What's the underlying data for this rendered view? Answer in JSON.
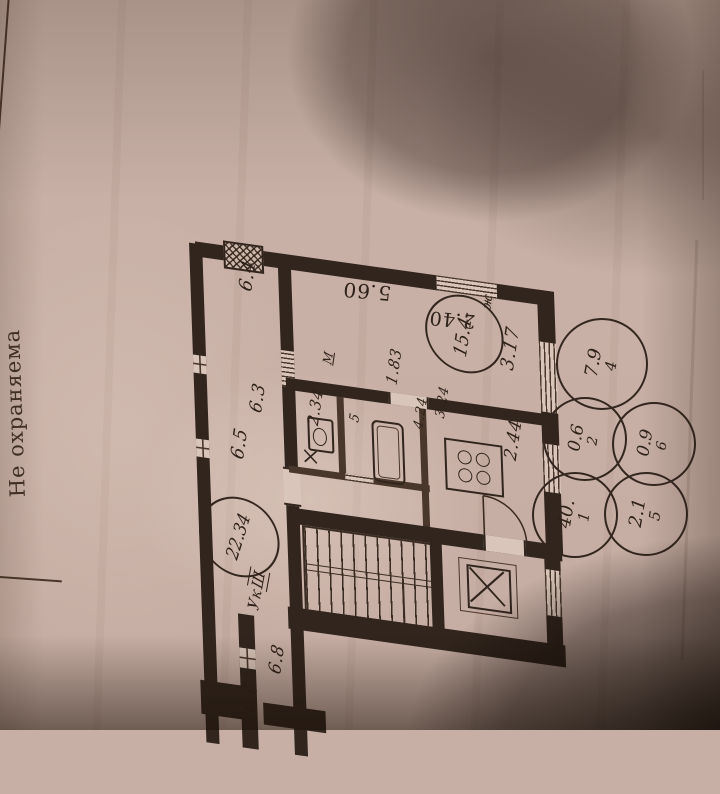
{
  "colors": {
    "paper": "#cab2a8",
    "ink": "#31251d"
  },
  "side_note": "Не охраняема",
  "corridor": {
    "dim_top": "6.4",
    "dim_mid": "6.5",
    "dim_inner": "6.3",
    "dim_lower": "6.8",
    "dim_bottom": "6.6",
    "area_circle": "22.34",
    "stair_label_a": "Ук",
    "stair_label_b": "Ш"
  },
  "apartment": {
    "living_area": "15.4-",
    "living_suffix": "ж.",
    "dim_length_top": "5.60",
    "dim_width_left": "2.40",
    "dim_width_right": "3.17",
    "dim_door": "1.83",
    "dim_hall": "2.34",
    "dim_kitchen_w": "2.44",
    "dim_kitchen_a": "3.24",
    "dim_kitchen_b": "4.24",
    "bath_mark": "5",
    "radiator_mark": "М"
  },
  "area_circles": [
    {
      "area": "7.9",
      "number": "4"
    },
    {
      "area": "0.6",
      "number": "2"
    },
    {
      "area": "0.9",
      "number": "6"
    },
    {
      "area": "40.",
      "number": "1"
    },
    {
      "area": "2.1",
      "number": "5"
    }
  ]
}
